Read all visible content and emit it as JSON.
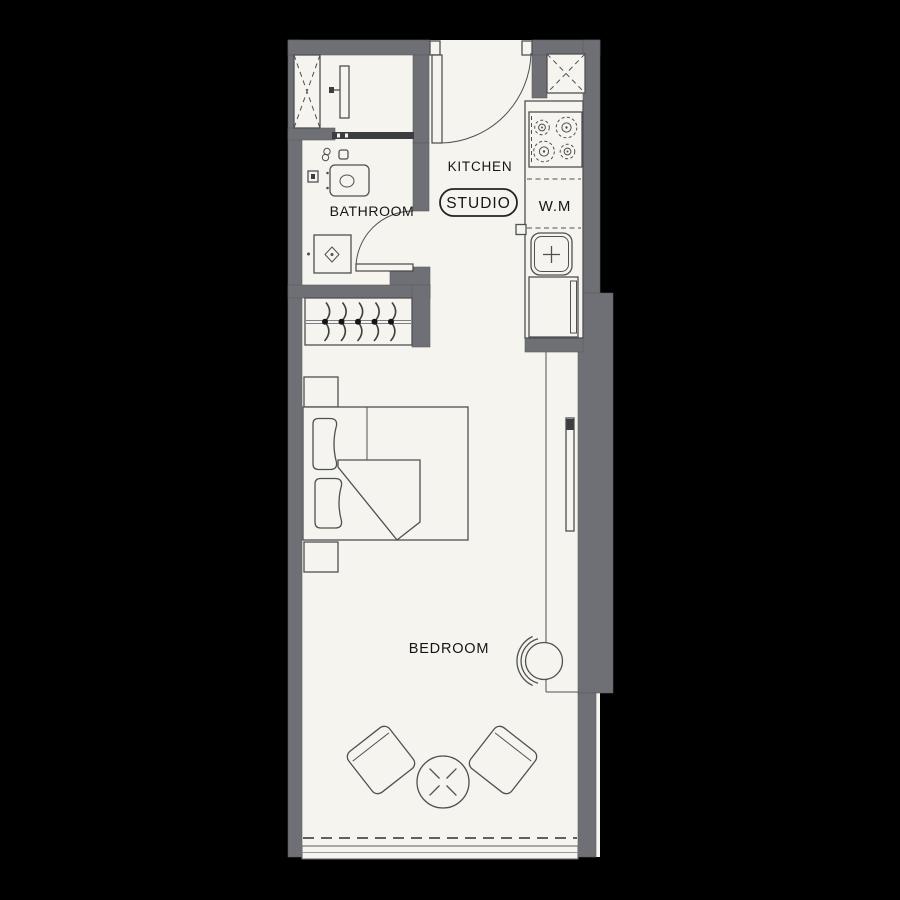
{
  "plan": {
    "type": "studio-apartment-floor-plan",
    "labels": {
      "kitchen": "KITCHEN",
      "studio": "STUDIO",
      "bathroom": "BATHROOM",
      "washing_machine": "W.M",
      "bedroom": "BEDROOM"
    },
    "fixtures": [
      "entry-door",
      "duct-shaft-left",
      "duct-shaft-right",
      "shower-column",
      "sliding-door-track",
      "washbasin-vanity",
      "shower-tray",
      "bathroom-door",
      "wardrobe-hangers",
      "kitchen-counter",
      "stove-four-burners",
      "washing-machine-space",
      "kitchen-sink",
      "fridge-cabinet",
      "double-bed",
      "nightstand",
      "pillows",
      "duvet-fold",
      "armchair-left",
      "armchair-right",
      "round-table",
      "tub-chair",
      "tall-window",
      "balcony-window-band"
    ]
  },
  "colors": {
    "background": "#000000",
    "wall": "#6e7075",
    "wall_edge": "#595a5e",
    "floor": "#f5f4ef",
    "line": "#4f5052",
    "dark_fitting": "#3c3d40",
    "label_text": "#161616"
  }
}
